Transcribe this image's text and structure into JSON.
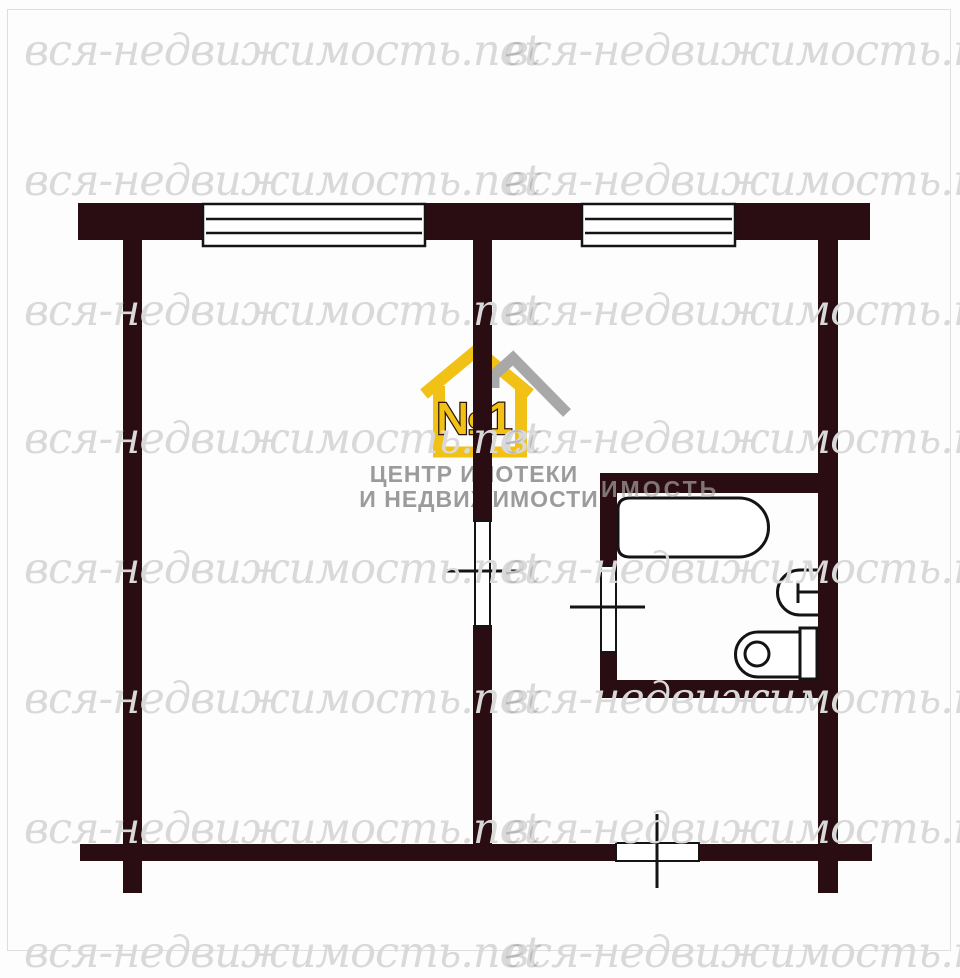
{
  "page": {
    "background": "#fdfdfd",
    "frame_border_color": "#dedede"
  },
  "watermark": {
    "text": "вся-недвижимость.net",
    "color": "#d9d9d9",
    "rows": 8,
    "columns": 2,
    "fragment_text": "ИМОСТЬ"
  },
  "logo": {
    "badge_number": "№1",
    "line1": "ЦЕНТР ИПОТЕКИ",
    "line2": "И НЕДВИЖИМОСТИ",
    "house_color": "#f1c115",
    "roof_accent_color": "#a8a8a8",
    "text_color": "#9b9b9b",
    "number_outline_color": "#2e1508"
  },
  "floor_plan": {
    "wall_color": "#2a0d12",
    "line_color": "#141414",
    "windows": [
      "window-top-left",
      "window-top-right"
    ],
    "doors": [
      "room-door",
      "bathroom-door",
      "entrance-door"
    ],
    "fixtures": [
      "bathtub",
      "sink",
      "toilet"
    ]
  }
}
